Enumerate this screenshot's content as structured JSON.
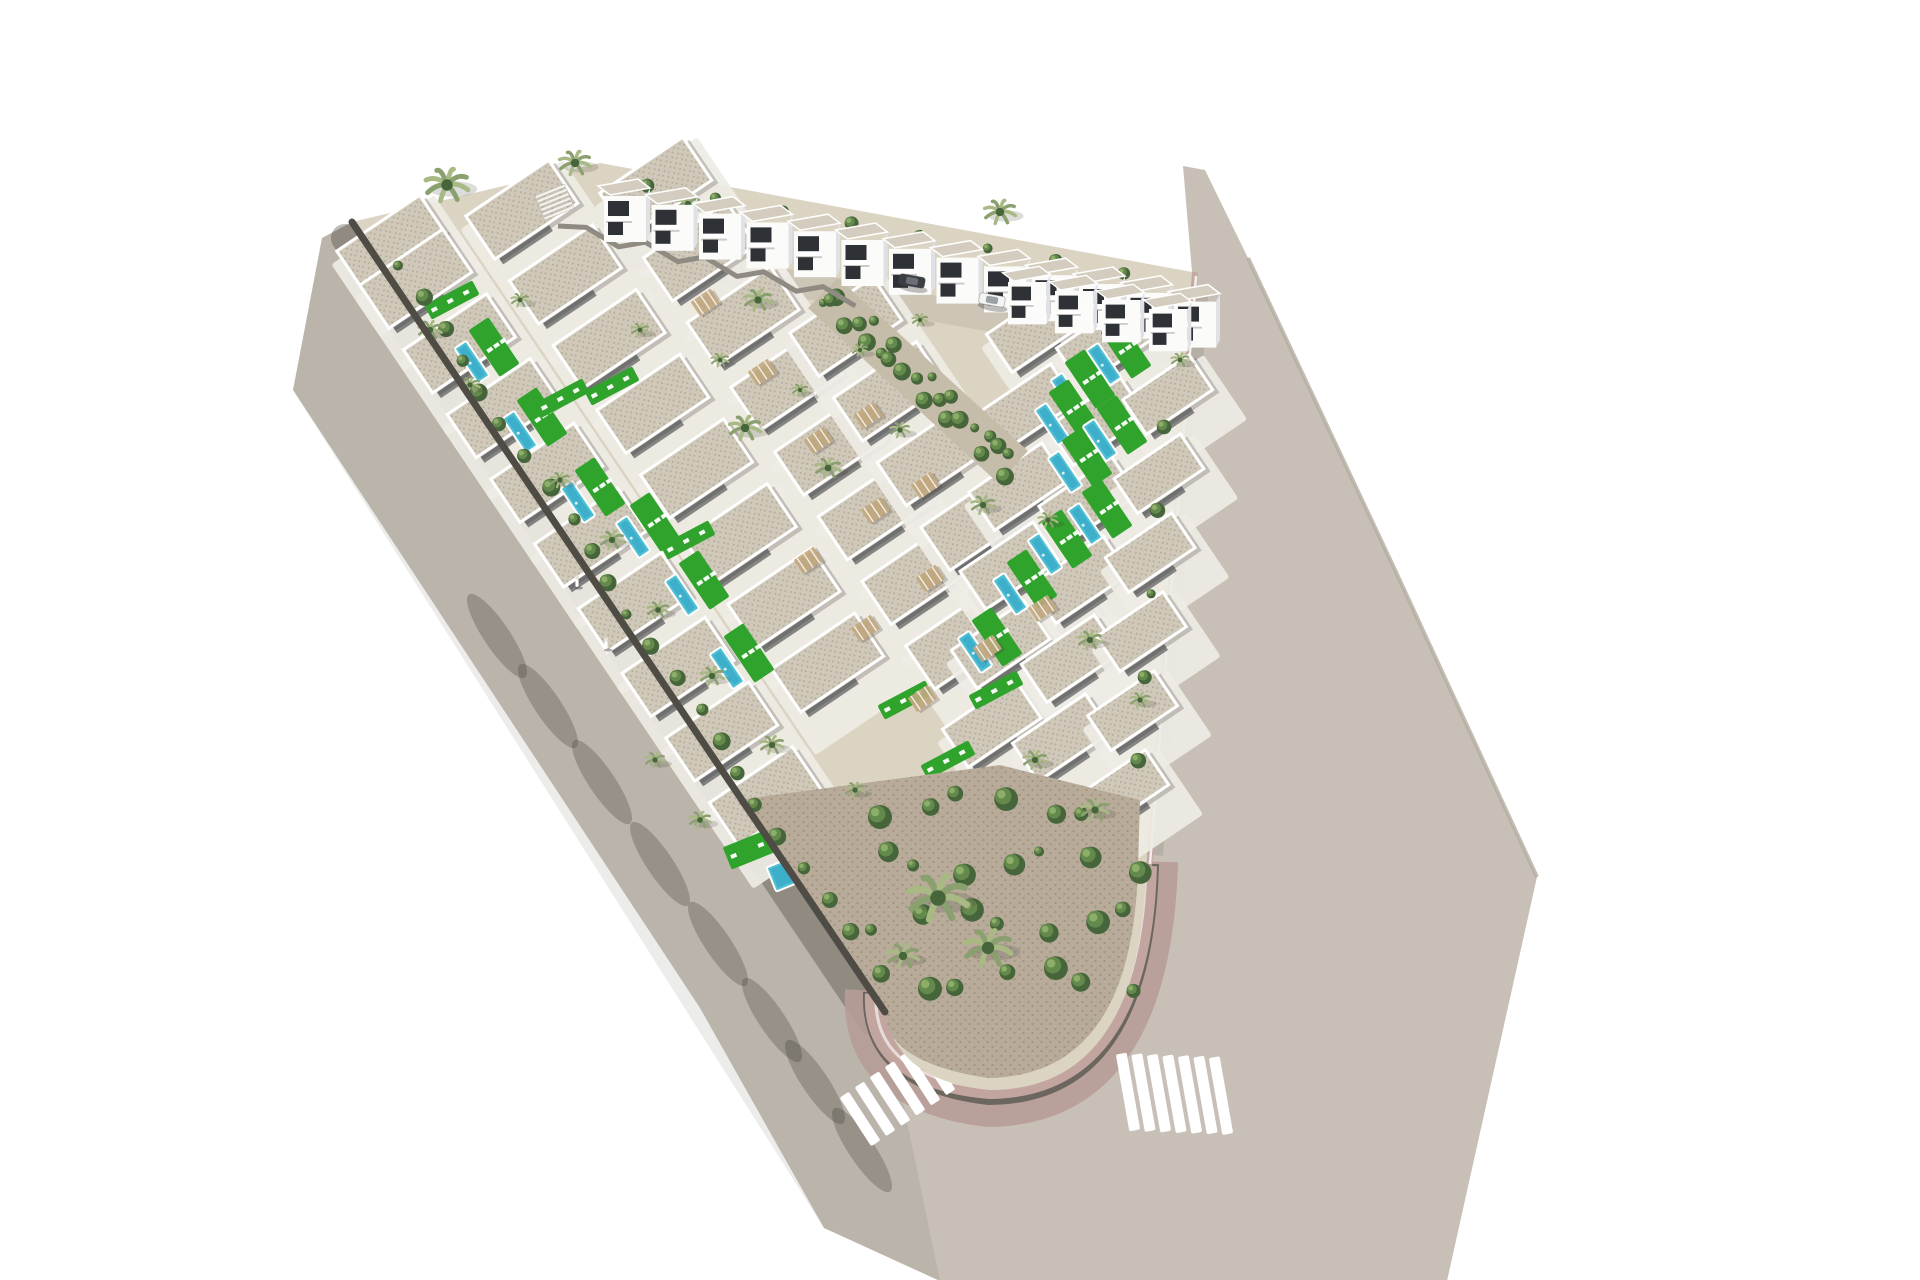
{
  "title": "Aerial 3D render of a white villa resort development on a triangular plot",
  "scene_type": "architectural-aerial-visualization",
  "features": [
    "white villas",
    "private pools",
    "green lawn decks with sun loungers",
    "palm trees",
    "perimeter roads",
    "zebra crosswalks",
    "rounded corner sidewalk",
    "dark boundary wall",
    "internal street with cars"
  ],
  "counts": {
    "two_story_back_row_houses": 13,
    "two_story_right_houses": 4,
    "single_story_villas": 50,
    "pools": 16,
    "palm_trees": 35,
    "crosswalks": 2,
    "cars": 2,
    "pedestrians": 2
  },
  "palette": {
    "road": "#c8c0b6",
    "street": "#cdc5b5",
    "base": "#dcd4c3",
    "dirt": "#c6bcaa",
    "sidewalkPink": "#c3a5a0",
    "sidewalkOuter": "#b79c97",
    "curb": "#6b675f",
    "curbLight": "#b3aba0",
    "wall": "#4f4c45",
    "zig": "#8f8b83",
    "white": "#fbfbfa",
    "shade": "#dfe1e5",
    "platform": "#eeece5",
    "roofBase": "#d0c9ba",
    "roofDot": "#b3ac9c",
    "roofTop": "#d4cdbf",
    "window": "#2e3136",
    "lawn": "#2fa32b",
    "lawnBright": "#3db832",
    "pool": "#4fc0d4",
    "poolDeep": "#2e9ec2",
    "gravelBase": "#b8ab9a",
    "gravelDot": "#a2937f",
    "vegDark": "#46653a",
    "vegMid": "#64894c",
    "vegLight": "#8cae68",
    "palmA": "#8ba06f",
    "palmB": "#a8b984",
    "pergola": "#c2a87e",
    "stripe": "#ffffff",
    "carDark": "#3b3e43",
    "carWhite": "#f4f4f2"
  },
  "scene": {
    "villa_rows": [
      {
        "x": 395,
        "y": 248,
        "count": 1
      },
      {
        "x": 418,
        "y": 282,
        "count": 9
      },
      {
        "x": 524,
        "y": 213,
        "count": 8
      },
      {
        "x": 658,
        "y": 190,
        "count": 8
      },
      {
        "x": 848,
        "y": 330,
        "count": 6
      },
      {
        "x": 1038,
        "y": 332,
        "count": 6,
        "dx": -8.8,
        "dy": 79,
        "w": 88,
        "h": 46
      },
      {
        "x": 1108,
        "y": 346,
        "count": 6,
        "dx": -8.8,
        "dy": 79,
        "w": 88,
        "h": 46
      },
      {
        "x": 1170,
        "y": 398,
        "count": 6,
        "dx": -8.8,
        "dy": 79,
        "w": 80,
        "h": 42
      }
    ],
    "back_rows": [
      {
        "x": 604,
        "y": 196,
        "count": 13,
        "dx": 47.5,
        "dy": 8.8,
        "scale": 1
      },
      {
        "x": 1008,
        "y": 282,
        "count": 4,
        "dx": 47,
        "dy": 9,
        "scale": 0.92
      }
    ],
    "pools": [
      [
        472,
        362
      ],
      [
        520,
        432
      ],
      [
        578,
        502
      ],
      [
        633,
        537
      ],
      [
        682,
        595
      ],
      [
        727,
        668
      ],
      [
        1104,
        364
      ],
      [
        1068,
        394
      ],
      [
        1052,
        424
      ],
      [
        1100,
        440
      ],
      [
        1065,
        472
      ],
      [
        1085,
        524
      ],
      [
        1045,
        554
      ],
      [
        1010,
        594
      ],
      [
        975,
        652
      ]
    ],
    "corner_pool": {
      "x": 800,
      "y": 868,
      "w": 62,
      "h": 26,
      "rot": -22
    },
    "corner_lawn": {
      "x": 768,
      "y": 842,
      "w": 88,
      "h": 24,
      "rot": -22
    },
    "lawns": [
      [
        452,
        300
      ],
      [
        562,
        398
      ],
      [
        612,
        386
      ],
      [
        688,
        540
      ],
      [
        830,
        858
      ],
      [
        905,
        700
      ],
      [
        948,
        760
      ],
      [
        996,
        690
      ]
    ],
    "pergolas": [
      [
        705,
        302
      ],
      [
        762,
        372
      ],
      [
        818,
        440
      ],
      [
        875,
        510
      ],
      [
        930,
        578
      ],
      [
        987,
        648
      ],
      [
        868,
        415
      ],
      [
        925,
        485
      ],
      [
        1042,
        608
      ],
      [
        808,
        560
      ],
      [
        865,
        628
      ],
      [
        922,
        698
      ]
    ],
    "palms": [
      [
        447,
        185,
        22
      ],
      [
        575,
        163,
        16
      ],
      [
        688,
        204,
        12
      ],
      [
        1000,
        212,
        16
      ],
      [
        758,
        300,
        14
      ],
      [
        745,
        428,
        16
      ],
      [
        828,
        468,
        13
      ],
      [
        900,
        430,
        10
      ],
      [
        983,
        505,
        12
      ],
      [
        1048,
        520,
        10
      ],
      [
        612,
        540,
        12
      ],
      [
        560,
        480,
        10
      ],
      [
        658,
        610,
        11
      ],
      [
        712,
        676,
        12
      ],
      [
        772,
        745,
        12
      ],
      [
        938,
        898,
        30
      ],
      [
        988,
        948,
        24
      ],
      [
        903,
        956,
        16
      ],
      [
        1090,
        640,
        12
      ],
      [
        1140,
        700,
        10
      ],
      [
        1035,
        760,
        12
      ],
      [
        1095,
        810,
        14
      ],
      [
        430,
        330,
        12
      ],
      [
        470,
        385,
        10
      ],
      [
        520,
        300,
        9
      ],
      [
        640,
        330,
        9
      ],
      [
        720,
        360,
        9
      ],
      [
        800,
        390,
        8
      ],
      [
        860,
        350,
        8
      ],
      [
        920,
        320,
        8
      ],
      [
        1120,
        330,
        10
      ],
      [
        1180,
        360,
        9
      ],
      [
        655,
        760,
        10
      ],
      [
        700,
        820,
        11
      ],
      [
        855,
        790,
        10
      ]
    ],
    "palm_road_shadows": [
      [
        497,
        636
      ],
      [
        548,
        706
      ],
      [
        602,
        782
      ],
      [
        660,
        864
      ],
      [
        718,
        944
      ],
      [
        772,
        1020
      ],
      [
        815,
        1082
      ],
      [
        862,
        1150
      ]
    ],
    "crosswalks": {
      "left": {
        "x": 935,
        "y": 1068,
        "stepX": -15,
        "stepY": 10.2,
        "count": 6,
        "len": 58,
        "w": 11,
        "rot": 57
      },
      "right": {
        "x": 1128,
        "y": 1092,
        "stepX": 15.5,
        "stepY": 0.6,
        "count": 7,
        "len": 78,
        "w": 11,
        "rot": 80
      }
    },
    "cars": [
      {
        "x": 912,
        "y": 281,
        "rot": 10,
        "color": "dark"
      },
      {
        "x": 992,
        "y": 300,
        "rot": 10,
        "color": "white"
      }
    ],
    "pedestrians": [
      [
        577,
        584
      ],
      [
        606,
        646
      ]
    ]
  }
}
